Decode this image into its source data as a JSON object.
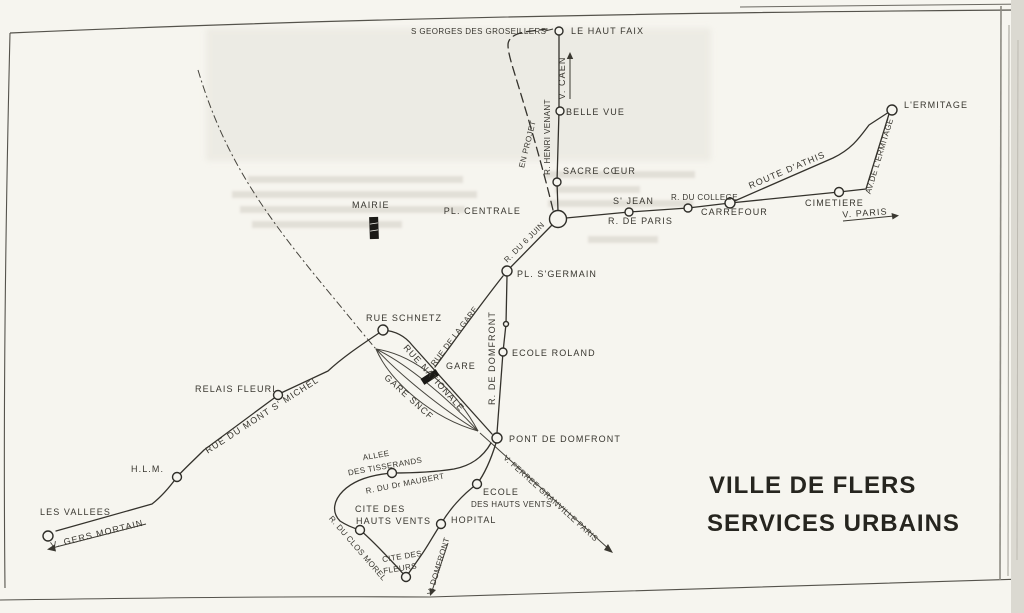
{
  "title": {
    "line1": "VILLE DE FLERS",
    "line2": "SERVICES URBAINS"
  },
  "map": {
    "stations": {
      "s_georges": "S GEORGES DES GROSEILLERS",
      "le_haut_faix": "LE HAUT FAIX",
      "belle_vue": "BELLE VUE",
      "sacre_coeur": "SACRE CŒUR",
      "pl_centrale": "PL. CENTRALE",
      "mairie": "MAIRIE",
      "s_jean": "S' JEAN",
      "r_du_college": "R. DU COLLEGE",
      "carrefour": "CARREFOUR",
      "cimetiere": "CIMETIERE",
      "l_ermitage": "L'ERMITAGE",
      "pl_s_germain": "PL. S'GERMAIN",
      "ecole_roland": "ECOLE ROLAND",
      "rue_schnetz": "RUE SCHNETZ",
      "gare": "GARE",
      "pont_de_domfront": "PONT DE DOMFRONT",
      "relais_fleuri": "RELAIS FLEURI",
      "hlm": "H.L.M.",
      "les_vallees": "LES VALLEES",
      "allee_l1": "ALLEE",
      "allee_l2": "DES TISSERANDS",
      "cite_hv_l1": "CITE DES",
      "cite_hv_l2": "HAUTS VENTS",
      "cite_fl_l1": "CITE DES",
      "cite_fl_l2": "FLEURS",
      "hopital": "HOPITAL",
      "ecole_hv_l1": "ECOLE",
      "ecole_hv_l2": "DES HAUTS VENTS"
    },
    "streets": {
      "r_henri_venant": "R. HENRI VENANT",
      "en_projet": "EN PROJET",
      "r_de_paris": "R. DE PARIS",
      "route_d_athis": "ROUTE D'ATHIS",
      "av_de_l_ermitage": "AV.DE L'ERMITAGE",
      "r_du_6_juin": "R. DU 6 JUIN",
      "r_de_domfront": "R. DE DOMFRONT",
      "rue_de_la_gare": "RUE DE LA GARE",
      "rue_nationale": "RUE NATIONALE",
      "gare_sncf": "GARE SNCF",
      "v_ferree": "V. FERREE GRANVILLE PARIS",
      "rue_du_mont_s_michel": "RUE DU MONT S' MICHEL",
      "r_du_dr_maubert": "R. DU Dr MAUBERT",
      "r_du_clos_morel": "R. DU CLOS MOREL"
    },
    "directions": {
      "v_caen": "V. CAEN",
      "v_paris": "V. PARIS",
      "v_gers_mortain": "V. GERS  MORTAIN",
      "v_domfront": "V. DOMFRONT"
    }
  },
  "colors": {
    "ink": "#34322c",
    "paper": "#f6f5ef",
    "title_ink": "#26251f"
  }
}
